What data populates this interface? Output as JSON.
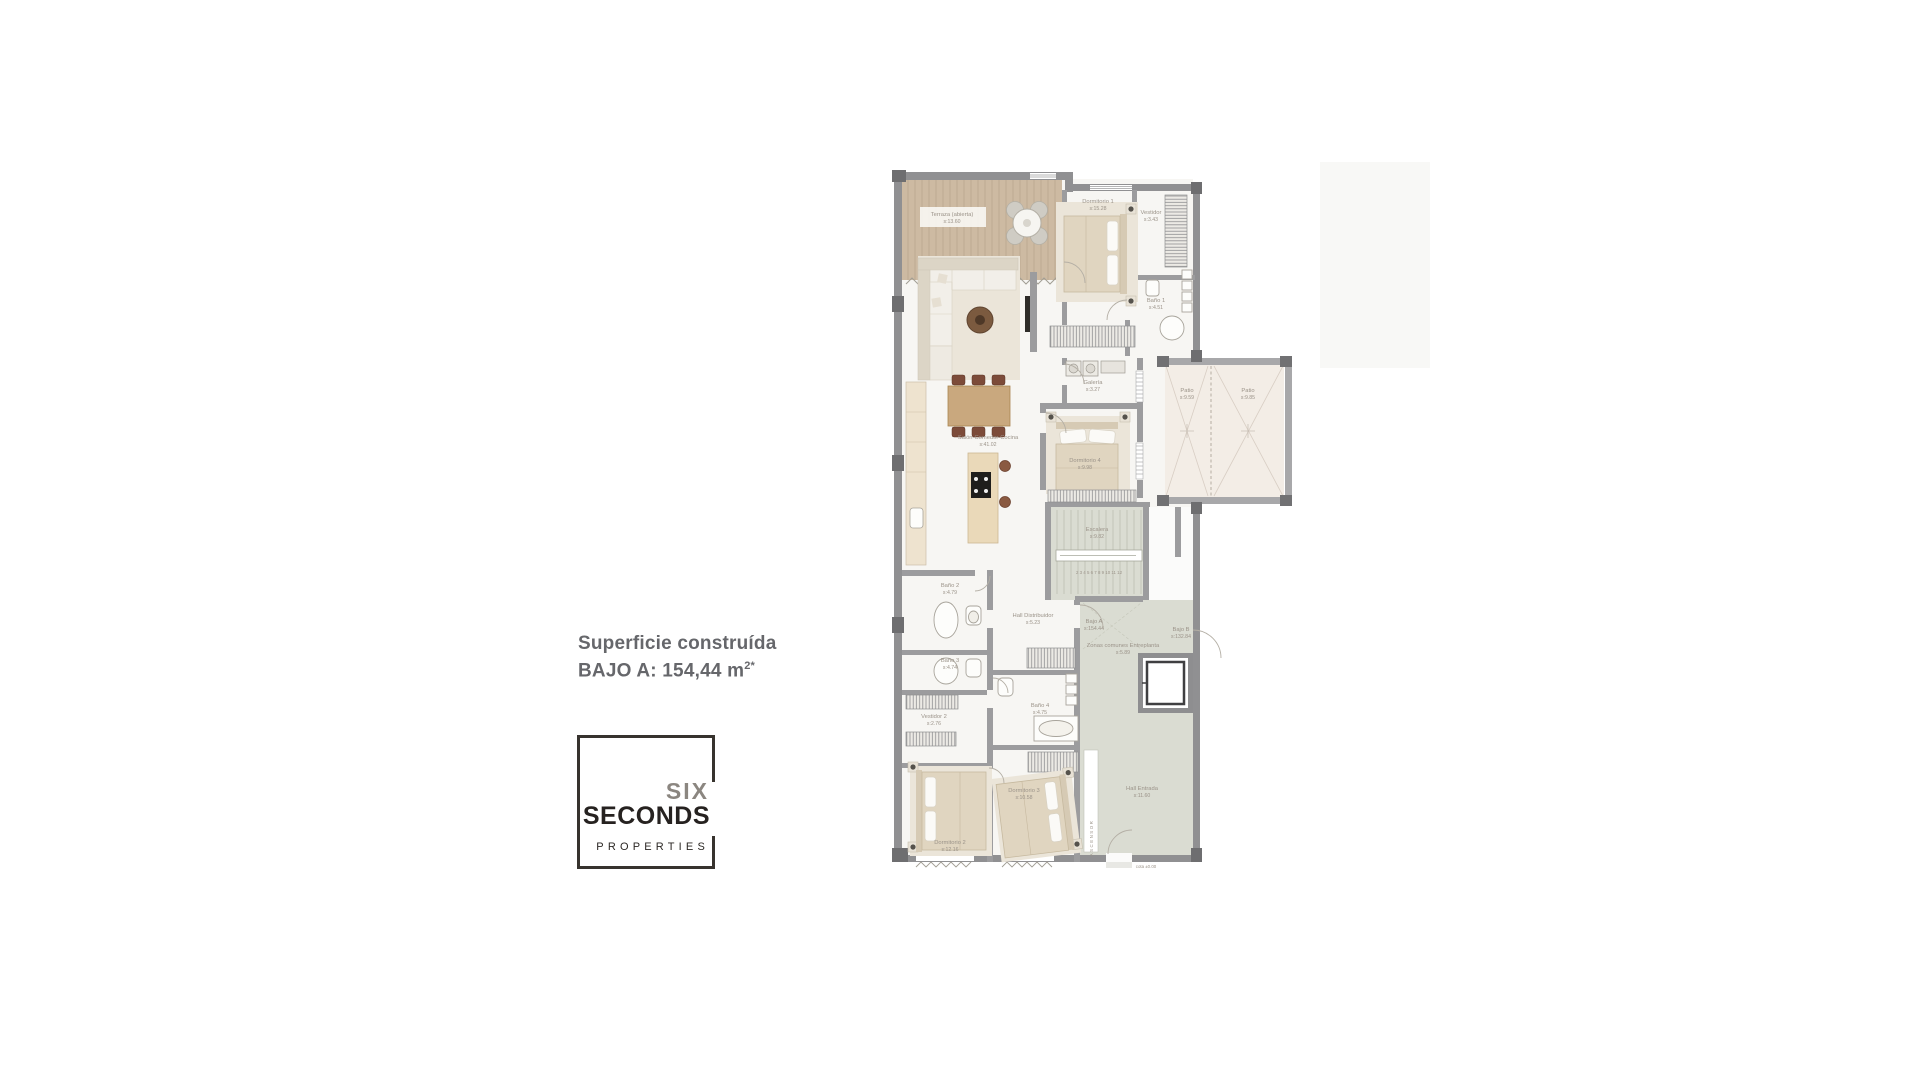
{
  "page": {
    "background": "#ffffff"
  },
  "summary": {
    "line1": "Superficie construída",
    "line2": "BAJO A: 154,44 m",
    "line2_sup": "2*"
  },
  "logo": {
    "word1": "SIX",
    "word2": "SECONDS",
    "word3": "PROPERTIES"
  },
  "colors": {
    "wall": "#909092",
    "wall_dark": "#6e6e70",
    "partition": "#9c9c9e",
    "floor": "#f7f6f3",
    "terrace_wood": "#cdbaa2",
    "communal_zone": "#dadcd2",
    "patio_floor": "#f3ede6",
    "furniture_beige": "#e0d5c0",
    "table_wood": "#c9a87e",
    "chair_brown": "#7c4b39",
    "label_text": "#9b9389",
    "summary_text": "#66676b",
    "logo_gray": "#8b8680",
    "logo_black": "#262220"
  },
  "floorplan": {
    "rooms": {
      "terraza": {
        "name": "Terraza (abierta)",
        "area": "s:13.60"
      },
      "dormitorio1": {
        "name": "Dormitorio 1",
        "area": "s:15.28"
      },
      "vestidor": {
        "name": "Vestidor",
        "area": "s:3.43"
      },
      "bano1": {
        "name": "Baño 1",
        "area": "s:4.51"
      },
      "galeria": {
        "name": "Galería",
        "area": "s:3.27"
      },
      "salon": {
        "name": "Salón-Comedor-Cocina",
        "area": "s:41.02"
      },
      "dormitorio4": {
        "name": "Dormitorio 4",
        "area": "s:9.98"
      },
      "patio1": {
        "name": "Patio",
        "area": "s:9.59"
      },
      "patio2": {
        "name": "Patio",
        "area": "s:9.85"
      },
      "escalera": {
        "name": "Escalera",
        "area": "s:9.82"
      },
      "bano2": {
        "name": "Baño 2",
        "area": "s:4.79"
      },
      "bano3": {
        "name": "Baño 3",
        "area": "s:4.74"
      },
      "hall_distribuidor": {
        "name": "Hall Distribuidor",
        "area": "s:5.23"
      },
      "bajo_a": {
        "name": "Bajo A",
        "area": "s:154.44"
      },
      "zonas_comunes": {
        "name": "Zonas comunes Entreplanta",
        "area": "s:5.89"
      },
      "bajo_b": {
        "name": "Bajo B",
        "area": "s:132.84"
      },
      "bano4": {
        "name": "Baño 4",
        "area": "s:4.75"
      },
      "vestidor2": {
        "name": "Vestidor 2",
        "area": "s:2.76"
      },
      "dormitorio2": {
        "name": "Dormitorio 2",
        "area": "s:12.16"
      },
      "dormitorio3": {
        "name": "Dormitorio 3",
        "area": "s:10.58"
      },
      "hall_entrada": {
        "name": "Hall Entrada",
        "area": "s:11.60"
      }
    },
    "texts": {
      "ascensor": "ASCENSOR",
      "cota": "cota ±0.00",
      "steps": "2 3 4 5 6 7 8 9 10 11 12"
    }
  }
}
